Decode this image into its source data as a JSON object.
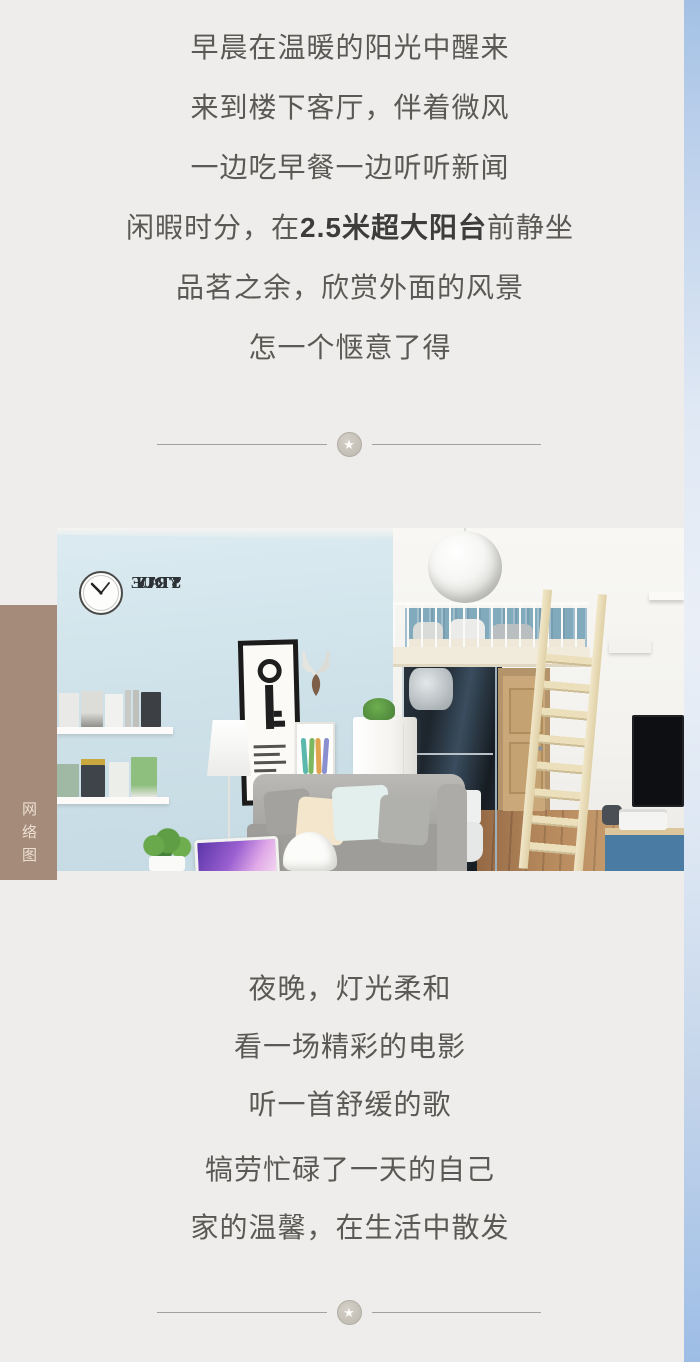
{
  "intro": {
    "lines": [
      "早晨在温暖的阳光中醒来",
      "来到楼下客厅，伴着微风",
      "一边吃早餐一边听听新闻"
    ],
    "line4_pre": "闲暇时分，在",
    "line4_bold": "2.5米超大阳台",
    "line4_post": "前静坐",
    "lines_tail": [
      "品茗之余，欣赏外面的风景",
      "怎一个惬意了得"
    ]
  },
  "outro": {
    "lines": [
      "夜晚，灯光柔和",
      "看一场精彩的电影",
      "听一首舒缓的歌",
      "犒劳忙碌了一天的自己",
      "家的温馨，在生活中散发"
    ]
  },
  "photo": {
    "decal_lines": [
      "STAY",
      "TRUE",
      "STAY",
      "YOU"
    ],
    "source_tag": "网络图"
  },
  "ornament": {
    "star": "★"
  },
  "colors": {
    "page_bg": "#eeedeb",
    "edge_strip_blue": "#a2c0e4",
    "source_tag_bg": "#a58b79",
    "source_tag_text": "#ecdfd0",
    "body_text": "#5b5955",
    "bold_text": "#3e3c3a",
    "divider_line": "#a3a19c",
    "wall_blue": "#cfe2ea"
  }
}
